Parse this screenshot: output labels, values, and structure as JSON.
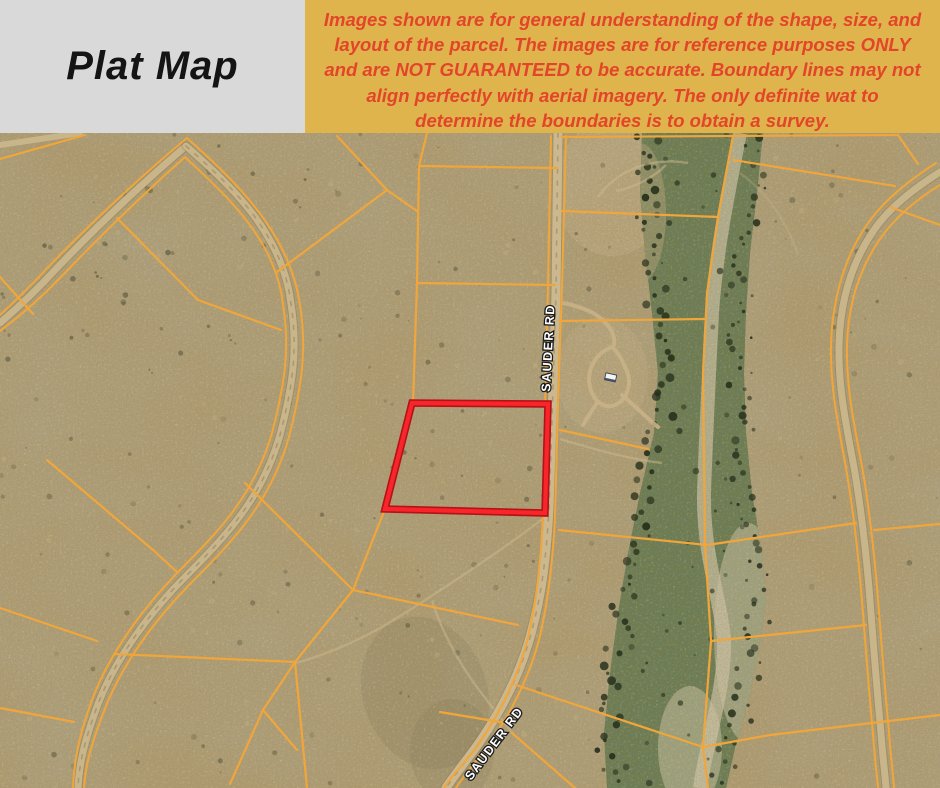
{
  "header": {
    "title": "Plat Map"
  },
  "banner": {
    "lines": [
      "Images shown are for general understanding of the shape, size, and",
      "layout of the parcel. The images are for reference purposes ONLY",
      "and are NOT GUARANTEED to be accurate. Boundary lines may not",
      "align perfectly with aerial imagery. The only definite wat to",
      "determine the boundaries is to obtain a survey."
    ]
  },
  "map": {
    "road_label_top": "SAUDER RD",
    "road_label_bottom": "SAUDER RD"
  },
  "colors": {
    "title_bg": "#d9d9d9",
    "banner_bg": "#dfb44c",
    "banner_text": "#e2452a",
    "parcel_line_yellow": "#f0a63b",
    "highlight_red": "#ee1c23",
    "desert_base": "#b09b6e",
    "wash_green": "#6e7b4c",
    "road_tan": "#c9b58a"
  }
}
